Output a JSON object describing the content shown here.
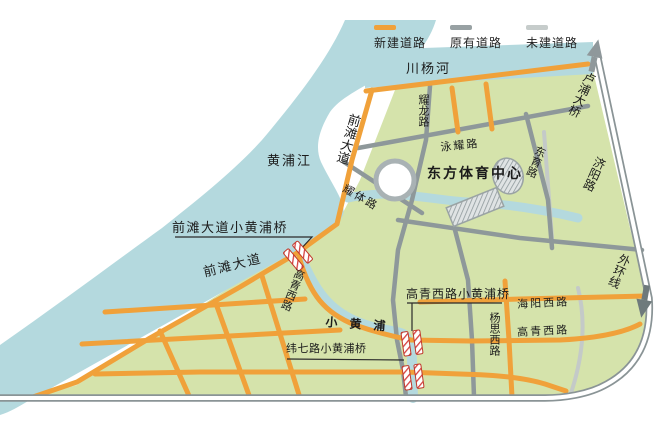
{
  "legend": {
    "items": [
      {
        "label": "新建道路",
        "color": "#f0a13a"
      },
      {
        "label": "原有道路",
        "color": "#98a1a3"
      },
      {
        "label": "未建道路",
        "color": "#c6cccb"
      }
    ]
  },
  "waterways": {
    "chuanyang_river": "川杨河",
    "huangpu_river": "黄浦江",
    "xiao_huangpu": "小黄浦"
  },
  "roads": {
    "qiantan_ave_north": "前滩大道",
    "qiantan_ave_south": "前滩大道",
    "yaolong_rd": "耀龙路",
    "yongyao_rd": "泳耀路",
    "yaoti_rd": "耀体路",
    "dongyu_rd": "东育路",
    "jiyang_rd": "济阳路",
    "gaoqing_west_rd_west": "高青西路",
    "gaoqing_west_rd_east": "高青西路",
    "haiyang_west_rd": "海阳西路",
    "yangsi_west_rd": "杨思西路",
    "outer_ring": "外环线",
    "lupu_bridge": "卢浦大桥"
  },
  "bridges": {
    "qiantan_bridge": "前滩大道小黄浦桥",
    "gaoqing_bridge": "高青西路小黄浦桥",
    "weiqi_bridge": "纬七路小黄浦桥"
  },
  "poi": {
    "sports_center": "东方体育中心"
  },
  "colors": {
    "new_road": "#f0a13a",
    "existing_road": "#8e989a",
    "unbuilt_road": "#c4cac8",
    "water": "#b4d9de",
    "land": "#d5e3ab",
    "bridge_marker": "#d64040"
  }
}
